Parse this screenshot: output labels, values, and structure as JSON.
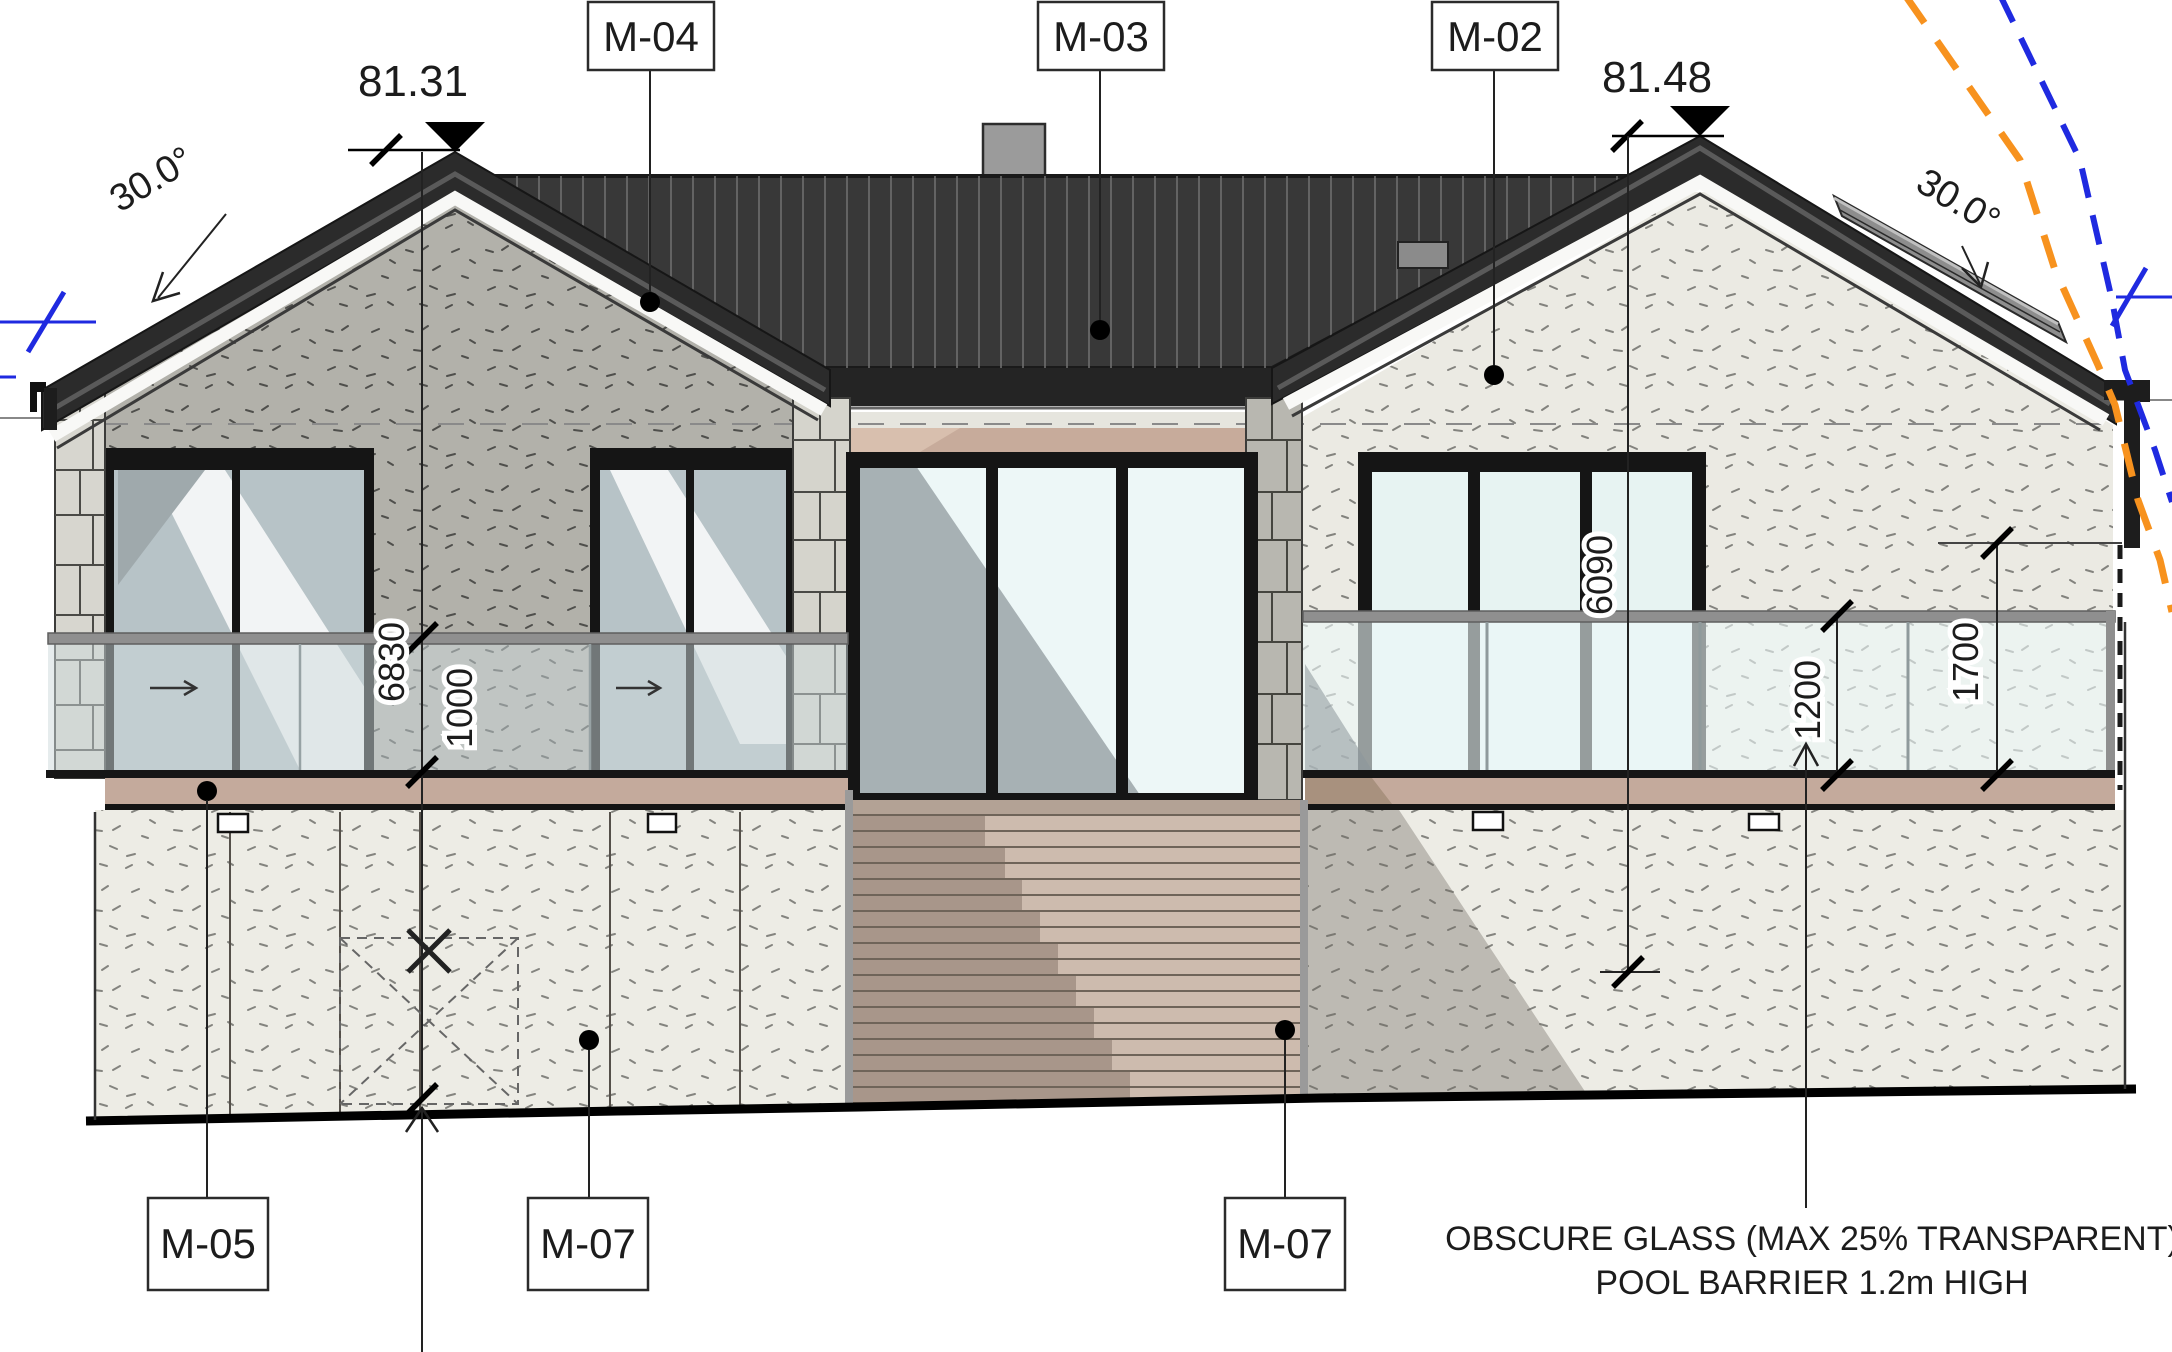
{
  "drawing": {
    "levels": {
      "left": "81.31",
      "right": "81.48"
    },
    "pitch_left": "30.0°",
    "pitch_right": "30.0°",
    "tags": {
      "m04": "M-04",
      "m03": "M-03",
      "m02": "M-02",
      "m05": "M-05",
      "m07_left": "M-07",
      "m07_right": "M-07"
    },
    "dims": {
      "left_total_height": "6830",
      "left_balustrade_height": "1000",
      "right_total_height": "6090",
      "pool_barrier_height": "1200",
      "right_barrier_check_height": "1700"
    },
    "note": {
      "line1": "OBSCURE GLASS (MAX 25% TRANSPARENT)",
      "line2": "POOL BARRIER 1.2m HIGH"
    }
  },
  "colors": {
    "roof_dark": "#343434",
    "barge_band": "#2b2b2b",
    "wall_lit": "#edece5",
    "wall_shade": "#b2b1aa",
    "deck_band": "#c4aa9c",
    "stair": "#cdbbae",
    "glass_shade": "#a7b1b4",
    "glass_lit": "#edf7f7",
    "boundary_blue": "#1f2ae0",
    "boundary_orange": "#f7921e"
  }
}
